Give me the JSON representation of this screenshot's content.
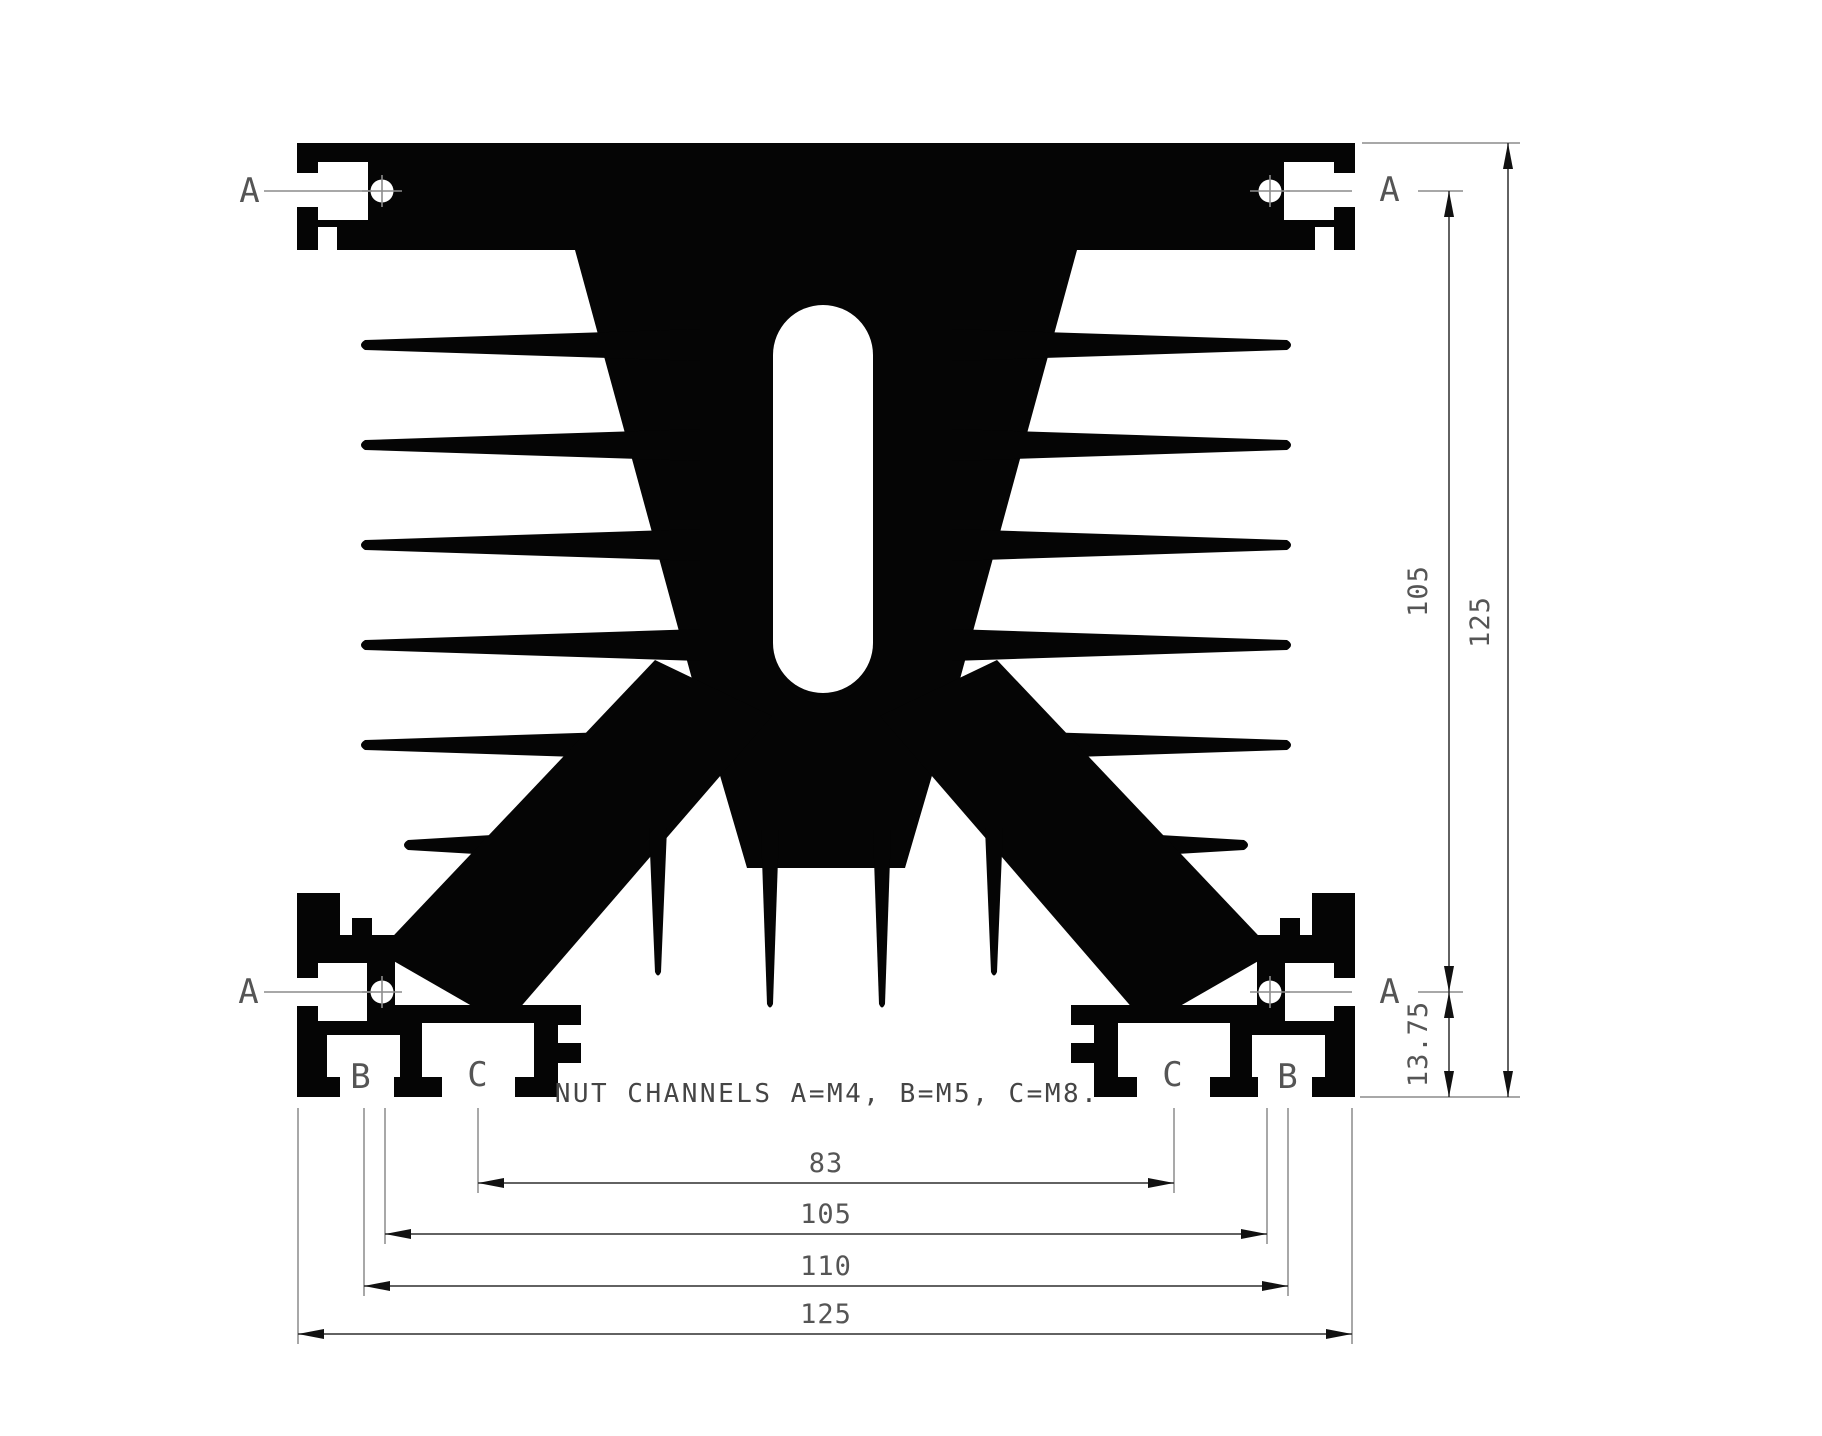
{
  "drawing": {
    "title_note": "NUT CHANNELS A=M4, B=M5, C=M8.",
    "channel_labels": {
      "top_left_a": "A",
      "top_right_a": "A",
      "bottom_left_a": "A",
      "bottom_right_a": "A",
      "left_b": "B",
      "left_c": "C",
      "right_c": "C",
      "right_b": "B"
    },
    "dimensions": {
      "channel_height": "105",
      "overall_height": "125",
      "foot_height": "13.75",
      "c_channel_spacing": "83",
      "b_inner_spacing": "105",
      "b_channel_spacing": "110",
      "overall_width": "125"
    },
    "colors": {
      "profile": "#050505",
      "cutout": "#ffffff",
      "dim_line": "#2e2e2e",
      "ext_line": "#8c8c8c",
      "leader_line": "#8c8c8c",
      "text": "#555555"
    }
  }
}
